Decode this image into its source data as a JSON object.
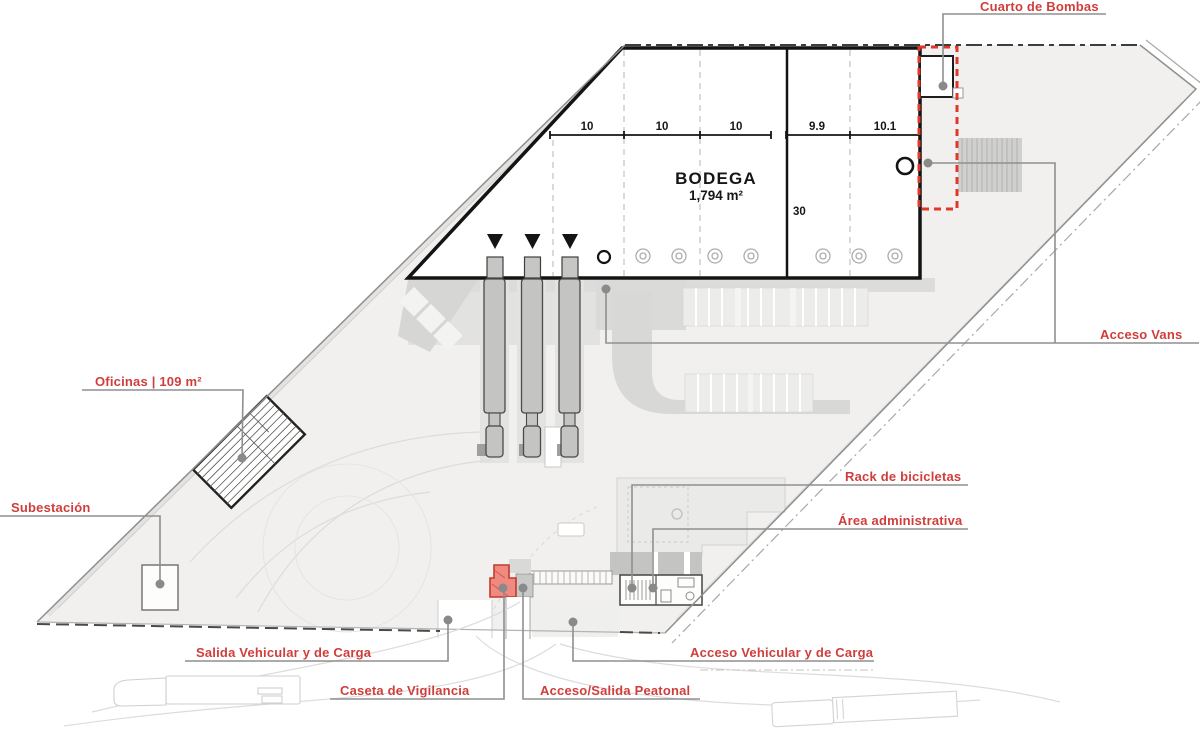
{
  "plan": {
    "bodega": {
      "name": "BODEGA",
      "area": "1,794 m²",
      "depth": "30",
      "bays": [
        "10",
        "10",
        "10",
        "9.9",
        "10.1"
      ]
    },
    "callouts": {
      "cuarto_de_bombas": "Cuarto de Bombas",
      "acceso_vans": "Acceso Vans",
      "oficinas": "Oficinas | 109 m²",
      "subestacion": "Subestación",
      "rack_bicicletas": "Rack de bicicletas",
      "area_administrativa": "Área administrativa",
      "salida_vehicular": "Salida Vehicular y de Carga",
      "caseta_vigilancia": "Caseta de Vigilancia",
      "acceso_peatonal": "Acceso/Salida Peatonal",
      "acceso_vehicular": "Acceso Vehicular y de Carga"
    },
    "colors": {
      "accent_red": "#cf3e3b",
      "dashed_red": "#e0372b",
      "caseta_fill": "#ef8a80",
      "leader_gray": "#8f8f8f",
      "site_fill": "#f1f0ef"
    }
  }
}
